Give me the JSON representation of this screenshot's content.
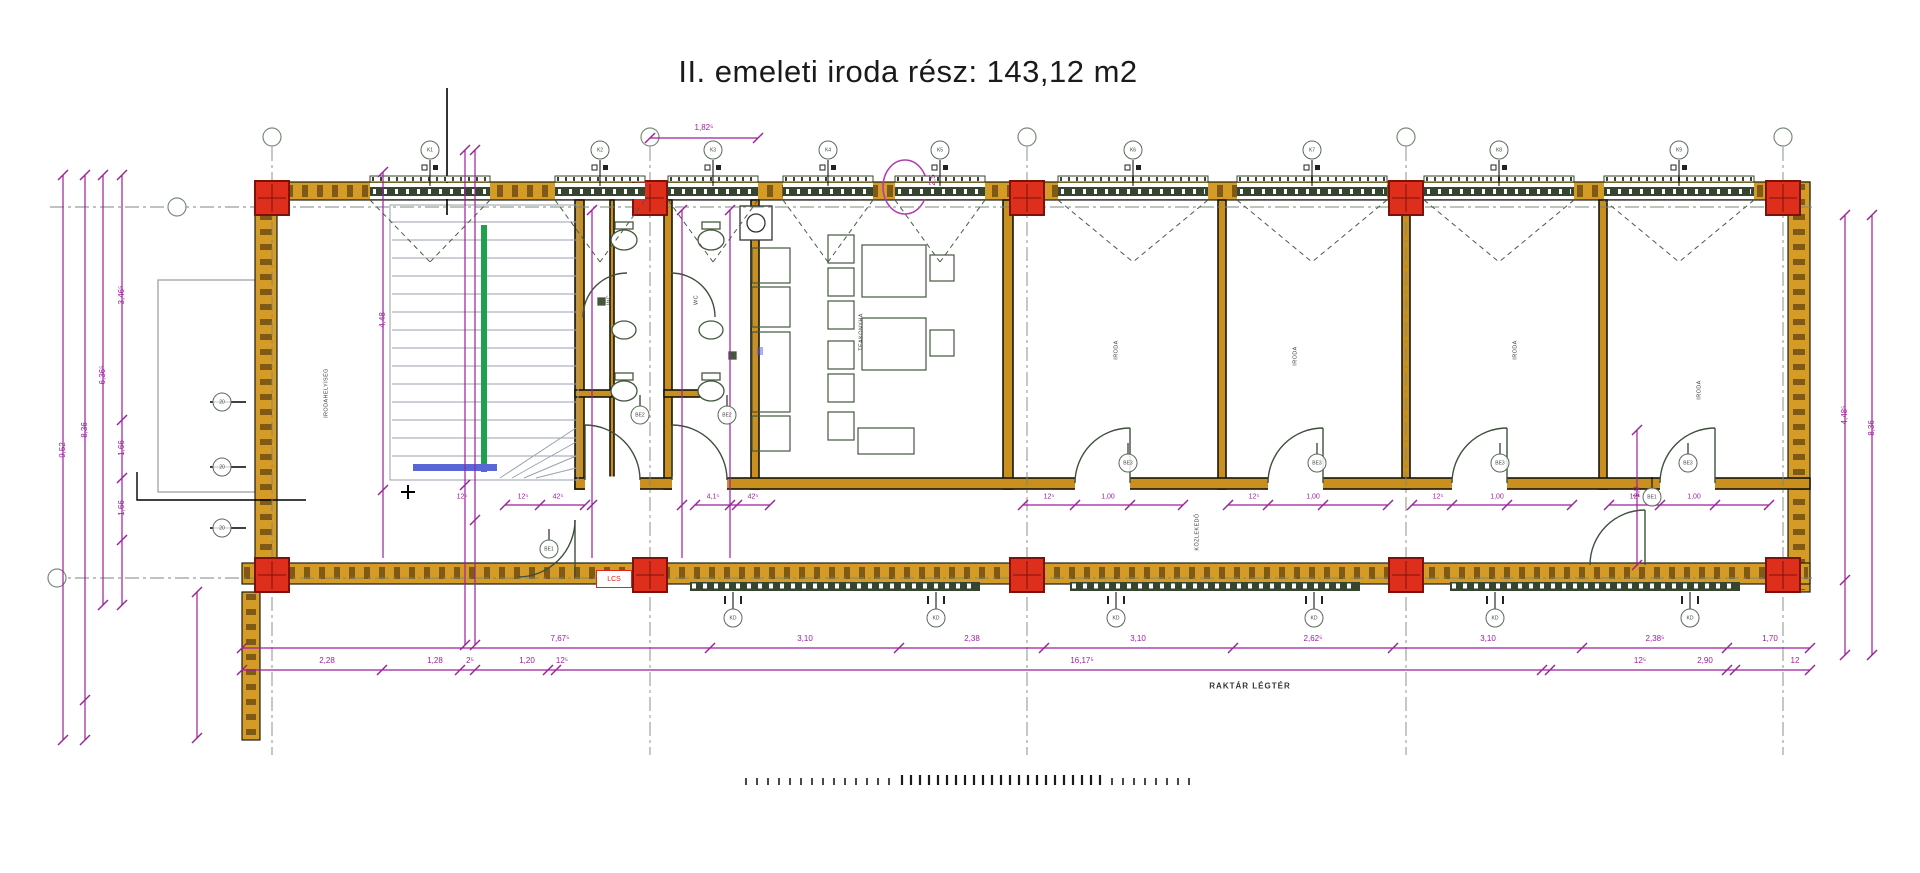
{
  "title": "II. emeleti iroda rész: 143,12 m2",
  "annotations": {
    "raktar": "RAKTÁR LÉGTÉR",
    "lcs": "LCS",
    "kitchen_glyph": "≣"
  },
  "colors": {
    "wall": "#D59B27",
    "wall_edge": "#1f1f10",
    "column": "#DE2F1C",
    "column_border": "#7E120A",
    "dim": "#9C1F9C",
    "axis": "#7a8a7a",
    "window": "#35452F",
    "fixture": "#44583F",
    "stair_gray": "#9aa2ac",
    "stair_green": "#1CA24D",
    "stair_blue": "#5A66D6",
    "stair_purple": "#8B1F8B",
    "title": "#1a1a1a",
    "lcs": "#E0251A",
    "annot": "#3d4f3d"
  },
  "grid": {
    "axes_x": [
      272,
      650,
      1027,
      1406,
      1783
    ],
    "axes_y": [
      207,
      578
    ],
    "bubbles": [
      [
        272,
        137
      ],
      [
        650,
        137
      ],
      [
        1027,
        137
      ],
      [
        1406,
        137
      ],
      [
        1783,
        137
      ],
      [
        177,
        207
      ],
      [
        57,
        578
      ]
    ]
  },
  "windows_top": [
    {
      "x": 430,
      "w": 120,
      "tag": "K1"
    },
    {
      "x": 600,
      "w": 90,
      "tag": "K2"
    },
    {
      "x": 713,
      "w": 90,
      "tag": "K3"
    },
    {
      "x": 828,
      "w": 90,
      "tag": "K4"
    },
    {
      "x": 940,
      "w": 90,
      "tag": "K5"
    },
    {
      "x": 1133,
      "w": 150,
      "tag": "K6"
    },
    {
      "x": 1312,
      "w": 150,
      "tag": "K7"
    },
    {
      "x": 1499,
      "w": 150,
      "tag": "K8"
    },
    {
      "x": 1679,
      "w": 150,
      "tag": "K9"
    }
  ],
  "windows_bottom_tags": [
    {
      "x": 733,
      "tag": "KD"
    },
    {
      "x": 936,
      "tag": "KD"
    },
    {
      "x": 1116,
      "tag": "KD"
    },
    {
      "x": 1314,
      "tag": "KD"
    },
    {
      "x": 1495,
      "tag": "KD"
    },
    {
      "x": 1690,
      "tag": "KD"
    }
  ],
  "doors": [
    {
      "x": 640,
      "y": 415,
      "tag": "BE2"
    },
    {
      "x": 727,
      "y": 415,
      "tag": "BE2"
    },
    {
      "x": 549,
      "y": 549,
      "tag": "BE1"
    },
    {
      "x": 1128,
      "y": 463,
      "tag": "BE3"
    },
    {
      "x": 1317,
      "y": 463,
      "tag": "BE3"
    },
    {
      "x": 1500,
      "y": 463,
      "tag": "BE3"
    },
    {
      "x": 1688,
      "y": 463,
      "tag": "BE3"
    },
    {
      "x": 1652,
      "y": 497,
      "tag": "BE1"
    }
  ],
  "left_wall_tags": [
    {
      "y": 402,
      "tag": "20"
    },
    {
      "y": 467,
      "tag": "20"
    },
    {
      "y": 528,
      "tag": "20"
    }
  ],
  "room_labels": [
    {
      "x": 327,
      "y": 393,
      "t": "IRODAHELYISÉG"
    },
    {
      "x": 862,
      "y": 332,
      "t": "TEAKONYHA"
    },
    {
      "x": 1117,
      "y": 350,
      "t": "IRODA"
    },
    {
      "x": 1296,
      "y": 356,
      "t": "IRODA"
    },
    {
      "x": 1516,
      "y": 350,
      "t": "IRODA"
    },
    {
      "x": 1700,
      "y": 390,
      "t": "IRODA"
    },
    {
      "x": 1198,
      "y": 532,
      "t": "KÖZLEKEDŐ"
    },
    {
      "x": 610,
      "y": 300,
      "t": "WC"
    },
    {
      "x": 697,
      "y": 300,
      "t": "WC"
    }
  ],
  "dim_labels": [
    {
      "x": 704,
      "y": 128,
      "t": "1,82⁵"
    },
    {
      "x": 933,
      "y": 180,
      "t": "2,5",
      "r": 1
    },
    {
      "x": 63,
      "y": 450,
      "t": "9,52",
      "r": 1
    },
    {
      "x": 85,
      "y": 430,
      "t": "8,36",
      "r": 1
    },
    {
      "x": 103,
      "y": 375,
      "t": "6,36⁵",
      "r": 1
    },
    {
      "x": 122,
      "y": 295,
      "t": "3,46⁵",
      "r": 1
    },
    {
      "x": 122,
      "y": 448,
      "t": "1,66",
      "r": 1
    },
    {
      "x": 122,
      "y": 508,
      "t": "1,66",
      "r": 1
    },
    {
      "x": 383,
      "y": 320,
      "t": "4,48",
      "r": 1
    },
    {
      "x": 1845,
      "y": 415,
      "t": "4,48⁵",
      "r": 1
    },
    {
      "x": 1872,
      "y": 428,
      "t": "8,36",
      "r": 1
    },
    {
      "x": 1637,
      "y": 492,
      "t": "1,9",
      "r": 1
    },
    {
      "x": 560,
      "y": 639,
      "t": "7,67⁵"
    },
    {
      "x": 805,
      "y": 639,
      "t": "3,10"
    },
    {
      "x": 972,
      "y": 639,
      "t": "2,38"
    },
    {
      "x": 1138,
      "y": 639,
      "t": "3,10"
    },
    {
      "x": 1313,
      "y": 639,
      "t": "2,62⁵"
    },
    {
      "x": 1488,
      "y": 639,
      "t": "3,10"
    },
    {
      "x": 1655,
      "y": 639,
      "t": "2,38⁵"
    },
    {
      "x": 1770,
      "y": 639,
      "t": "1,70"
    },
    {
      "x": 327,
      "y": 661,
      "t": "2,28"
    },
    {
      "x": 435,
      "y": 661,
      "t": "1,28"
    },
    {
      "x": 470,
      "y": 661,
      "t": "2⁵"
    },
    {
      "x": 527,
      "y": 661,
      "t": "1,20"
    },
    {
      "x": 562,
      "y": 661,
      "t": "12⁵"
    },
    {
      "x": 1082,
      "y": 661,
      "t": "16,17⁵"
    },
    {
      "x": 1640,
      "y": 661,
      "t": "12⁵"
    },
    {
      "x": 1705,
      "y": 661,
      "t": "2,90"
    },
    {
      "x": 1795,
      "y": 661,
      "t": "12"
    },
    {
      "x": 462,
      "y": 497,
      "t": "12⁵",
      "s": 7
    },
    {
      "x": 523,
      "y": 497,
      "t": "12⁵",
      "s": 7
    },
    {
      "x": 558,
      "y": 497,
      "t": "42⁵",
      "s": 7
    },
    {
      "x": 713,
      "y": 497,
      "t": "4,1⁵",
      "s": 7
    },
    {
      "x": 753,
      "y": 497,
      "t": "42⁵",
      "s": 7
    },
    {
      "x": 1049,
      "y": 497,
      "t": "12⁵",
      "s": 7
    },
    {
      "x": 1108,
      "y": 497,
      "t": "1,00",
      "s": 7
    },
    {
      "x": 1254,
      "y": 497,
      "t": "12⁵",
      "s": 7
    },
    {
      "x": 1313,
      "y": 497,
      "t": "1,00",
      "s": 7
    },
    {
      "x": 1438,
      "y": 497,
      "t": "12⁵",
      "s": 7
    },
    {
      "x": 1497,
      "y": 497,
      "t": "1,00",
      "s": 7
    },
    {
      "x": 1635,
      "y": 497,
      "t": "12⁵",
      "s": 7
    },
    {
      "x": 1694,
      "y": 497,
      "t": "1,00",
      "s": 7
    }
  ],
  "dim_lines": [
    {
      "x1": 63,
      "y1": 175,
      "x2": 63,
      "y2": 740,
      "ticks": [
        [
          63,
          175
        ],
        [
          63,
          740
        ]
      ]
    },
    {
      "x1": 85,
      "y1": 175,
      "x2": 85,
      "y2": 740,
      "ticks": [
        [
          85,
          175
        ],
        [
          85,
          700
        ],
        [
          85,
          740
        ]
      ]
    },
    {
      "x1": 103,
      "y1": 175,
      "x2": 103,
      "y2": 605,
      "ticks": [
        [
          103,
          175
        ],
        [
          103,
          605
        ]
      ]
    },
    {
      "x1": 122,
      "y1": 175,
      "x2": 122,
      "y2": 605,
      "ticks": [
        [
          122,
          175
        ],
        [
          122,
          420
        ],
        [
          122,
          478
        ],
        [
          122,
          540
        ],
        [
          122,
          605
        ]
      ]
    },
    {
      "x1": 383,
      "y1": 172,
      "x2": 383,
      "y2": 558,
      "ticks": [
        [
          383,
          172
        ],
        [
          383,
          490
        ]
      ]
    },
    {
      "x1": 465,
      "y1": 150,
      "x2": 465,
      "y2": 645,
      "ticks": [
        [
          465,
          150
        ],
        [
          465,
          485
        ],
        [
          465,
          645
        ]
      ]
    },
    {
      "x1": 475,
      "y1": 150,
      "x2": 475,
      "y2": 645,
      "ticks": [
        [
          475,
          150
        ],
        [
          475,
          520
        ],
        [
          475,
          645
        ]
      ]
    },
    {
      "x1": 592,
      "y1": 210,
      "x2": 592,
      "y2": 558,
      "ticks": [
        [
          592,
          210
        ],
        [
          592,
          505
        ]
      ]
    },
    {
      "x1": 682,
      "y1": 210,
      "x2": 682,
      "y2": 558,
      "ticks": [
        [
          682,
          210
        ],
        [
          682,
          505
        ]
      ]
    },
    {
      "x1": 730,
      "y1": 210,
      "x2": 730,
      "y2": 558,
      "ticks": [
        [
          730,
          210
        ],
        [
          730,
          505
        ]
      ]
    },
    {
      "x1": 1637,
      "y1": 430,
      "x2": 1637,
      "y2": 565,
      "ticks": [
        [
          1637,
          430
        ],
        [
          1637,
          565
        ]
      ]
    },
    {
      "x1": 1845,
      "y1": 215,
      "x2": 1845,
      "y2": 655,
      "ticks": [
        [
          1845,
          215
        ],
        [
          1845,
          580
        ],
        [
          1845,
          655
        ]
      ]
    },
    {
      "x1": 1872,
      "y1": 215,
      "x2": 1872,
      "y2": 655,
      "ticks": [
        [
          1872,
          215
        ],
        [
          1872,
          655
        ]
      ]
    },
    {
      "x1": 197,
      "y1": 592,
      "x2": 197,
      "y2": 738,
      "ticks": [
        [
          197,
          592
        ],
        [
          197,
          738
        ]
      ]
    },
    {
      "x1": 650,
      "y1": 138,
      "x2": 758,
      "y2": 138,
      "ticks": [
        [
          650,
          138
        ],
        [
          758,
          138
        ]
      ]
    },
    {
      "x1": 505,
      "y1": 505,
      "x2": 585,
      "y2": 505,
      "ticks": [
        [
          505,
          505
        ],
        [
          540,
          505
        ],
        [
          585,
          505
        ]
      ]
    },
    {
      "x1": 695,
      "y1": 505,
      "x2": 770,
      "y2": 505,
      "ticks": [
        [
          695,
          505
        ],
        [
          737,
          505
        ],
        [
          770,
          505
        ]
      ]
    },
    {
      "x1": 1023,
      "y1": 505,
      "x2": 1183,
      "y2": 505,
      "ticks": [
        [
          1023,
          505
        ],
        [
          1075,
          505
        ],
        [
          1130,
          505
        ],
        [
          1183,
          505
        ]
      ]
    },
    {
      "x1": 1228,
      "y1": 505,
      "x2": 1388,
      "y2": 505,
      "ticks": [
        [
          1228,
          505
        ],
        [
          1268,
          505
        ],
        [
          1323,
          505
        ],
        [
          1388,
          505
        ]
      ]
    },
    {
      "x1": 1412,
      "y1": 505,
      "x2": 1572,
      "y2": 505,
      "ticks": [
        [
          1412,
          505
        ],
        [
          1452,
          505
        ],
        [
          1507,
          505
        ],
        [
          1572,
          505
        ]
      ]
    },
    {
      "x1": 1609,
      "y1": 505,
      "x2": 1769,
      "y2": 505,
      "ticks": [
        [
          1609,
          505
        ],
        [
          1660,
          505
        ],
        [
          1715,
          505
        ],
        [
          1769,
          505
        ]
      ]
    },
    {
      "x1": 242,
      "y1": 648,
      "x2": 1810,
      "y2": 648,
      "ticks": [
        [
          242,
          648
        ],
        [
          710,
          648
        ],
        [
          899,
          648
        ],
        [
          1044,
          648
        ],
        [
          1233,
          648
        ],
        [
          1393,
          648
        ],
        [
          1582,
          648
        ],
        [
          1727,
          648
        ],
        [
          1810,
          648
        ]
      ]
    },
    {
      "x1": 242,
      "y1": 670,
      "x2": 1810,
      "y2": 670,
      "ticks": [
        [
          242,
          670
        ],
        [
          382,
          670
        ],
        [
          460,
          670
        ],
        [
          475,
          670
        ],
        [
          548,
          670
        ],
        [
          556,
          670
        ],
        [
          1542,
          670
        ],
        [
          1550,
          670
        ],
        [
          1727,
          670
        ],
        [
          1735,
          670
        ],
        [
          1810,
          670
        ]
      ]
    }
  ],
  "scalebar": {
    "y": 785,
    "groups": [
      {
        "x": 746,
        "n": 14,
        "step": 11,
        "h": 7
      },
      {
        "x": 902,
        "n": 23,
        "step": 9,
        "h": 10
      },
      {
        "x": 1112,
        "n": 8,
        "step": 11,
        "h": 7
      }
    ]
  }
}
